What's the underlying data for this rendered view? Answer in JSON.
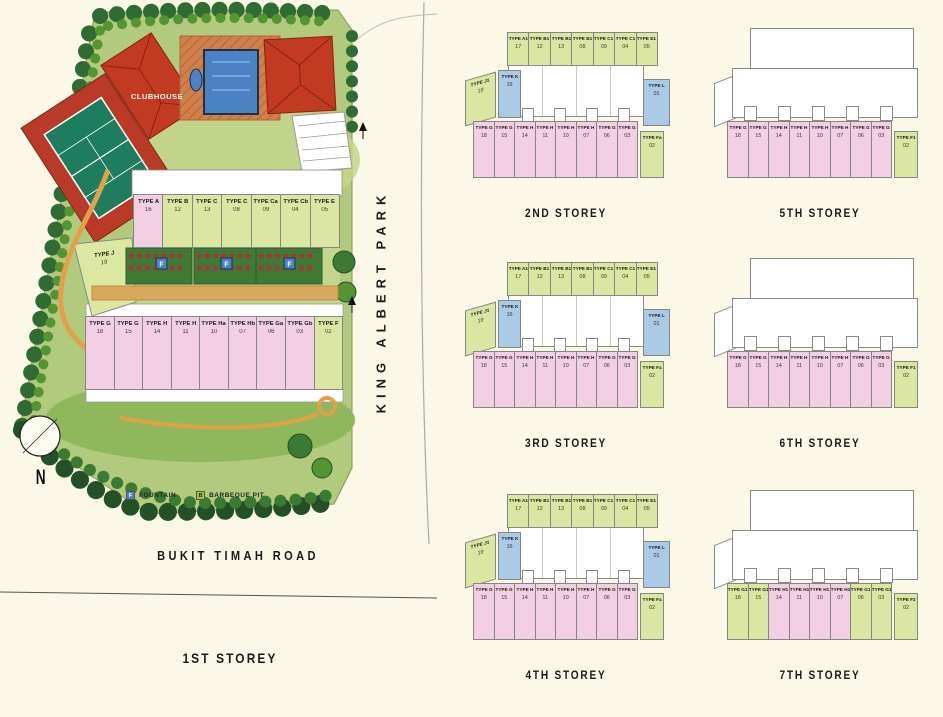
{
  "colors": {
    "background": "#fbf8e8",
    "unit_green": "#dbe6a2",
    "unit_pink": "#f2cfe3",
    "unit_blue": "#aacae6",
    "roof_red": "#c23a22",
    "pool_blue": "#4a82c4",
    "lawn_green": "#b2ca7e",
    "tree_green": "#2f6b33",
    "court_green": "#1f7d5f",
    "path_orange": "#e3a04a",
    "legend_fountain": "#4a82c4",
    "legend_barbeque": "#a8bf4a"
  },
  "site_plan": {
    "title": "1ST STOREY",
    "road_bottom": "BUKIT TIMAH ROAD",
    "road_right": "KING ALBERT PARK",
    "clubhouse_label": "CLUBHOUSE",
    "compass_label": "N",
    "fountain_symbol": "F",
    "legend": [
      {
        "symbol": "F",
        "label": "FOUNTAIN"
      },
      {
        "symbol": "B",
        "label": "BARBEQUE PIT"
      }
    ],
    "upper_row": [
      {
        "type": "TYPE A",
        "unit": "16",
        "color": "pink"
      },
      {
        "type": "TYPE B",
        "unit": "12",
        "color": "green"
      },
      {
        "type": "TYPE C",
        "unit": "13",
        "color": "green"
      },
      {
        "type": "TYPE C",
        "unit": "08",
        "color": "green"
      },
      {
        "type": "TYPE Ca",
        "unit": "09",
        "color": "green"
      },
      {
        "type": "TYPE Cb",
        "unit": "04",
        "color": "green"
      },
      {
        "type": "TYPE E",
        "unit": "05",
        "color": "green"
      }
    ],
    "side_unit": {
      "type": "TYPE J",
      "unit": "19",
      "color": "green"
    },
    "lower_row": [
      {
        "type": "TYPE G",
        "unit": "18",
        "color": "pink"
      },
      {
        "type": "TYPE G",
        "unit": "15",
        "color": "pink"
      },
      {
        "type": "TYPE H",
        "unit": "14",
        "color": "pink"
      },
      {
        "type": "TYPE H",
        "unit": "11",
        "color": "pink"
      },
      {
        "type": "TYPE Ha",
        "unit": "10",
        "color": "pink"
      },
      {
        "type": "TYPE Hb",
        "unit": "07",
        "color": "pink"
      },
      {
        "type": "TYPE Ga",
        "unit": "06",
        "color": "pink"
      },
      {
        "type": "TYPE Gb",
        "unit": "03",
        "color": "pink"
      },
      {
        "type": "TYPE F",
        "unit": "02",
        "color": "green"
      }
    ]
  },
  "floors": [
    {
      "title": "2ND STOREY",
      "layout": "mid",
      "top_row": [
        {
          "type": "TYPE A1",
          "unit": "17",
          "color": "green"
        },
        {
          "type": "TYPE B1",
          "unit": "12",
          "color": "green"
        },
        {
          "type": "TYPE B1",
          "unit": "13",
          "color": "green"
        },
        {
          "type": "TYPE B1",
          "unit": "08",
          "color": "green"
        },
        {
          "type": "TYPE C1",
          "unit": "09",
          "color": "green"
        },
        {
          "type": "TYPE C1",
          "unit": "04",
          "color": "green"
        },
        {
          "type": "TYPE E1",
          "unit": "05",
          "color": "green"
        }
      ],
      "left_units": [
        {
          "type": "TYPE J1",
          "unit": "19",
          "color": "green"
        },
        {
          "type": "TYPE K",
          "unit": "16",
          "color": "blue"
        }
      ],
      "right_unit": {
        "type": "TYPE L",
        "unit": "01",
        "color": "blue"
      },
      "bottom_row": [
        {
          "type": "TYPE G",
          "unit": "18",
          "color": "pink"
        },
        {
          "type": "TYPE G",
          "unit": "15",
          "color": "pink"
        },
        {
          "type": "TYPE H",
          "unit": "14",
          "color": "pink"
        },
        {
          "type": "TYPE H",
          "unit": "11",
          "color": "pink"
        },
        {
          "type": "TYPE H",
          "unit": "10",
          "color": "pink"
        },
        {
          "type": "TYPE H",
          "unit": "07",
          "color": "pink"
        },
        {
          "type": "TYPE G",
          "unit": "06",
          "color": "pink"
        },
        {
          "type": "TYPE G",
          "unit": "03",
          "color": "pink"
        }
      ],
      "corner_unit": {
        "type": "TYPE Fa",
        "unit": "02",
        "color": "green"
      }
    },
    {
      "title": "5TH STOREY",
      "layout": "upper",
      "bottom_row": [
        {
          "type": "TYPE G",
          "unit": "18",
          "color": "pink"
        },
        {
          "type": "TYPE G",
          "unit": "15",
          "color": "pink"
        },
        {
          "type": "TYPE H",
          "unit": "14",
          "color": "pink"
        },
        {
          "type": "TYPE H",
          "unit": "11",
          "color": "pink"
        },
        {
          "type": "TYPE H",
          "unit": "10",
          "color": "pink"
        },
        {
          "type": "TYPE H",
          "unit": "07",
          "color": "pink"
        },
        {
          "type": "TYPE G",
          "unit": "06",
          "color": "pink"
        },
        {
          "type": "TYPE G",
          "unit": "03",
          "color": "pink"
        }
      ],
      "corner_unit": {
        "type": "TYPE F1",
        "unit": "02",
        "color": "green"
      }
    },
    {
      "title": "3RD STOREY",
      "layout": "mid",
      "top_row": [
        {
          "type": "TYPE A1",
          "unit": "17",
          "color": "green"
        },
        {
          "type": "TYPE B1",
          "unit": "12",
          "color": "green"
        },
        {
          "type": "TYPE B1",
          "unit": "13",
          "color": "green"
        },
        {
          "type": "TYPE B1",
          "unit": "08",
          "color": "green"
        },
        {
          "type": "TYPE C1",
          "unit": "09",
          "color": "green"
        },
        {
          "type": "TYPE C1",
          "unit": "04",
          "color": "green"
        },
        {
          "type": "TYPE E1",
          "unit": "05",
          "color": "green"
        }
      ],
      "left_units": [
        {
          "type": "TYPE J1",
          "unit": "19",
          "color": "green"
        },
        {
          "type": "TYPE K",
          "unit": "16",
          "color": "blue"
        }
      ],
      "right_unit": {
        "type": "TYPE L",
        "unit": "01",
        "color": "blue"
      },
      "bottom_row": [
        {
          "type": "TYPE G",
          "unit": "18",
          "color": "pink"
        },
        {
          "type": "TYPE G",
          "unit": "15",
          "color": "pink"
        },
        {
          "type": "TYPE H",
          "unit": "14",
          "color": "pink"
        },
        {
          "type": "TYPE H",
          "unit": "11",
          "color": "pink"
        },
        {
          "type": "TYPE H",
          "unit": "10",
          "color": "pink"
        },
        {
          "type": "TYPE H",
          "unit": "07",
          "color": "pink"
        },
        {
          "type": "TYPE G",
          "unit": "06",
          "color": "pink"
        },
        {
          "type": "TYPE G",
          "unit": "03",
          "color": "pink"
        }
      ],
      "corner_unit": {
        "type": "TYPE Fa",
        "unit": "02",
        "color": "green"
      }
    },
    {
      "title": "6TH STOREY",
      "layout": "upper",
      "bottom_row": [
        {
          "type": "TYPE G",
          "unit": "18",
          "color": "pink"
        },
        {
          "type": "TYPE G",
          "unit": "15",
          "color": "pink"
        },
        {
          "type": "TYPE H",
          "unit": "14",
          "color": "pink"
        },
        {
          "type": "TYPE H",
          "unit": "11",
          "color": "pink"
        },
        {
          "type": "TYPE H",
          "unit": "10",
          "color": "pink"
        },
        {
          "type": "TYPE H",
          "unit": "07",
          "color": "pink"
        },
        {
          "type": "TYPE G",
          "unit": "06",
          "color": "pink"
        },
        {
          "type": "TYPE G",
          "unit": "03",
          "color": "pink"
        }
      ],
      "corner_unit": {
        "type": "TYPE F1",
        "unit": "02",
        "color": "green"
      }
    },
    {
      "title": "4TH STOREY",
      "layout": "mid",
      "top_row": [
        {
          "type": "TYPE A1",
          "unit": "17",
          "color": "green"
        },
        {
          "type": "TYPE B1",
          "unit": "12",
          "color": "green"
        },
        {
          "type": "TYPE B1",
          "unit": "13",
          "color": "green"
        },
        {
          "type": "TYPE B1",
          "unit": "08",
          "color": "green"
        },
        {
          "type": "TYPE C1",
          "unit": "09",
          "color": "green"
        },
        {
          "type": "TYPE C1",
          "unit": "04",
          "color": "green"
        },
        {
          "type": "TYPE E1",
          "unit": "05",
          "color": "green"
        }
      ],
      "left_units": [
        {
          "type": "TYPE J1",
          "unit": "19",
          "color": "green"
        },
        {
          "type": "TYPE K",
          "unit": "16",
          "color": "blue"
        }
      ],
      "right_unit": {
        "type": "TYPE L",
        "unit": "01",
        "color": "blue"
      },
      "bottom_row": [
        {
          "type": "TYPE G",
          "unit": "18",
          "color": "pink"
        },
        {
          "type": "TYPE G",
          "unit": "15",
          "color": "pink"
        },
        {
          "type": "TYPE H",
          "unit": "14",
          "color": "pink"
        },
        {
          "type": "TYPE H",
          "unit": "11",
          "color": "pink"
        },
        {
          "type": "TYPE H",
          "unit": "10",
          "color": "pink"
        },
        {
          "type": "TYPE H",
          "unit": "07",
          "color": "pink"
        },
        {
          "type": "TYPE G",
          "unit": "06",
          "color": "pink"
        },
        {
          "type": "TYPE G",
          "unit": "03",
          "color": "pink"
        }
      ],
      "corner_unit": {
        "type": "TYPE Fa",
        "unit": "02",
        "color": "green"
      }
    },
    {
      "title": "7TH STOREY",
      "layout": "upper",
      "bottom_row": [
        {
          "type": "TYPE G1",
          "unit": "18",
          "color": "green"
        },
        {
          "type": "TYPE G1",
          "unit": "15",
          "color": "green"
        },
        {
          "type": "TYPE H1",
          "unit": "14",
          "color": "pink"
        },
        {
          "type": "TYPE H1",
          "unit": "11",
          "color": "pink"
        },
        {
          "type": "TYPE H1",
          "unit": "10",
          "color": "pink"
        },
        {
          "type": "TYPE H1",
          "unit": "07",
          "color": "pink"
        },
        {
          "type": "TYPE G1",
          "unit": "06",
          "color": "green"
        },
        {
          "type": "TYPE G1",
          "unit": "03",
          "color": "green"
        }
      ],
      "corner_unit": {
        "type": "TYPE F2",
        "unit": "02",
        "color": "green"
      }
    }
  ]
}
